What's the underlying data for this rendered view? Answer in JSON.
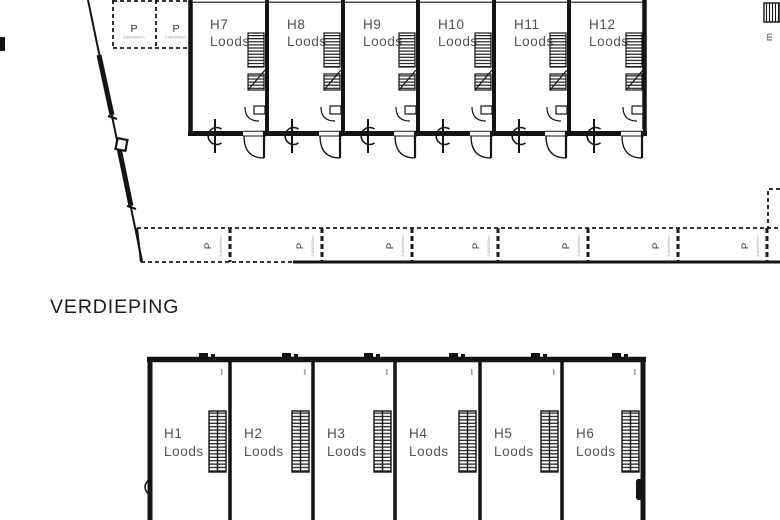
{
  "plan": {
    "heading": "VERDIEPING",
    "edge_label": "m",
    "top_building": {
      "units": [
        {
          "id": "H7",
          "type": "Loods"
        },
        {
          "id": "H8",
          "type": "Loods"
        },
        {
          "id": "H9",
          "type": "Loods"
        },
        {
          "id": "H10",
          "type": "Loods"
        },
        {
          "id": "H11",
          "type": "Loods"
        },
        {
          "id": "H12",
          "type": "Loods"
        }
      ]
    },
    "bottom_building": {
      "units": [
        {
          "id": "H1",
          "type": "Loods"
        },
        {
          "id": "H2",
          "type": "Loods"
        },
        {
          "id": "H3",
          "type": "Loods"
        },
        {
          "id": "H4",
          "type": "Loods"
        },
        {
          "id": "H5",
          "type": "Loods"
        },
        {
          "id": "H6",
          "type": "Loods"
        }
      ]
    },
    "parking_top": {
      "stalls": [
        {
          "label": "P",
          "dim": "240x500cm"
        },
        {
          "label": "P",
          "dim": "240x500cm"
        }
      ]
    },
    "parking_row": {
      "stalls": [
        {
          "label": "P",
          "dim": "240x500cm"
        },
        {
          "label": "P",
          "dim": "240x500cm"
        },
        {
          "label": "P",
          "dim": "240x500cm"
        },
        {
          "label": "P",
          "dim": "240x500cm"
        },
        {
          "label": "P",
          "dim": "240x500cm"
        },
        {
          "label": "P",
          "dim": "240x500cm"
        },
        {
          "label": "P",
          "dim": "240x500cm"
        }
      ]
    },
    "colors": {
      "wall": "#141414",
      "unit_label": "#4f4f4f",
      "heading": "#1c1c1c",
      "dim_text": "#909090",
      "background": "#ffffff"
    }
  }
}
